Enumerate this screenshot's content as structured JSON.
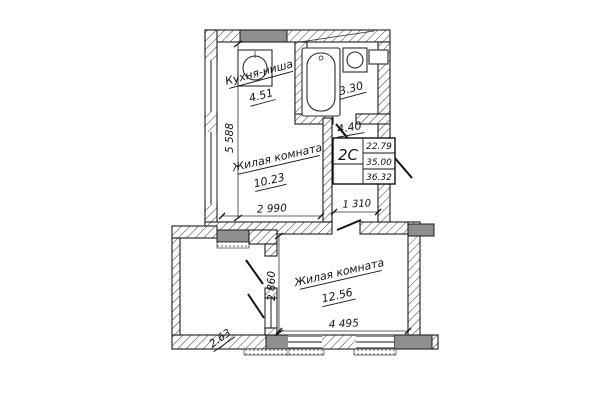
{
  "stamp": {
    "apartment_type": "2С",
    "living_area": "22.79",
    "apartment_area": "35.00",
    "total_area": "36.32"
  },
  "rooms": {
    "kitchen": {
      "label": "Кухня-ниша",
      "area": "4.51"
    },
    "bathroom": {
      "area": "3.30"
    },
    "hallway": {
      "area": "4.40"
    },
    "living_room_1": {
      "label": "Жилая комната",
      "area": "10.23"
    },
    "living_room_2": {
      "label": "Жилая комната",
      "area": "12.56"
    },
    "balcony": {
      "area": "2.63"
    }
  },
  "dimensions": {
    "upper_left_height_mm": "5 588",
    "living1_width_mm": "2 990",
    "hallway_width_mm": "1 310",
    "living2_height_mm": "2 860",
    "living2_width_mm": "4 495"
  },
  "colors": {
    "line": "#1b1b1b",
    "vent_fill": "#8f8f8f",
    "paper": "#ffffff"
  }
}
